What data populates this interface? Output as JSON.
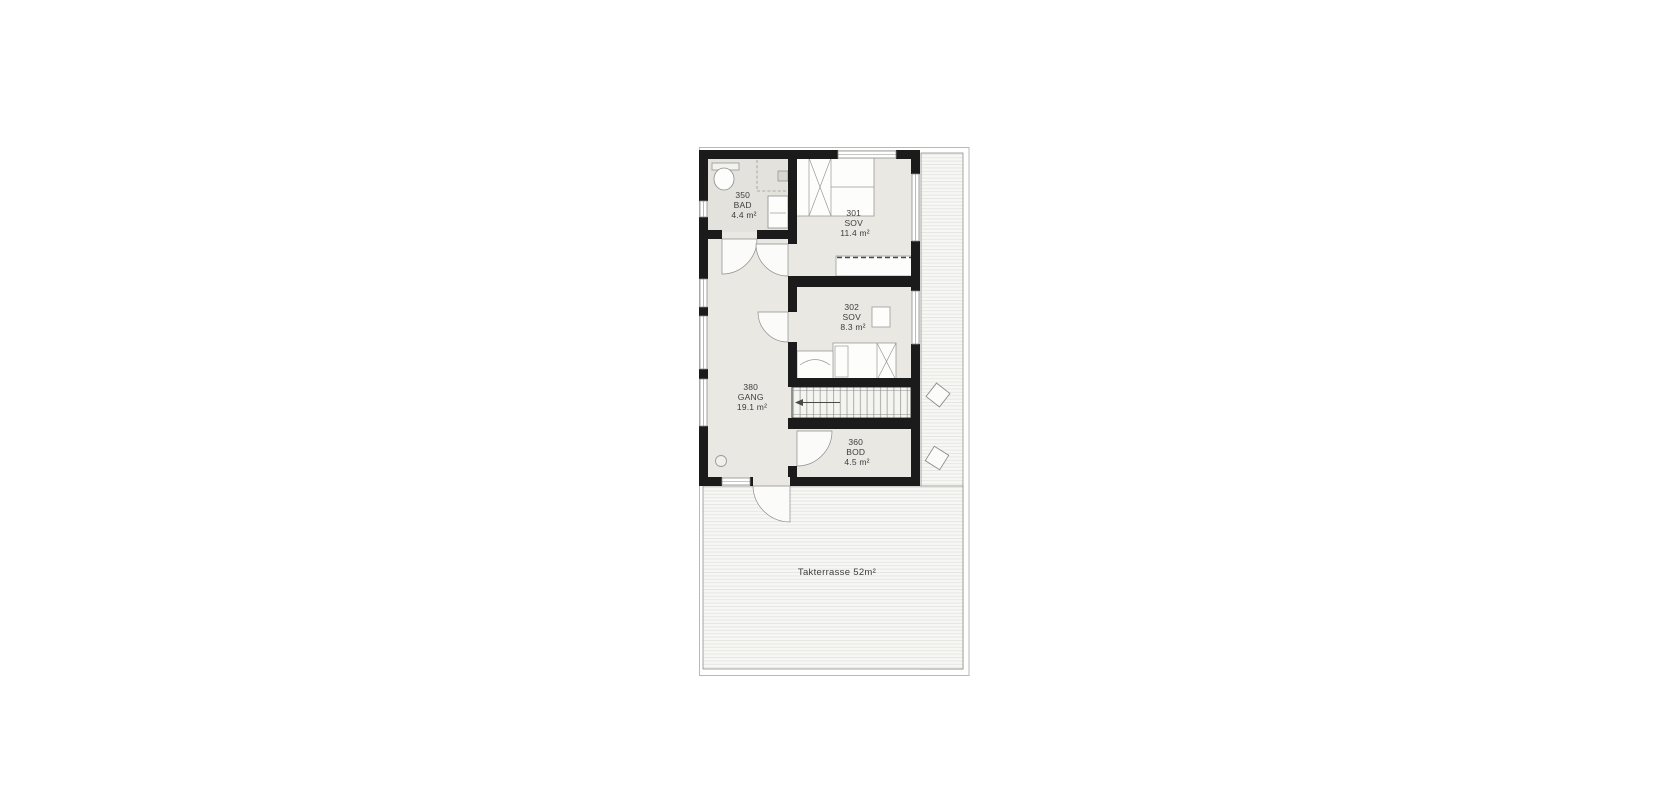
{
  "floorplan": {
    "title": "Upper floor plan with roof terrace",
    "rooms": [
      {
        "number": "350",
        "type": "BAD",
        "area": "4.4 m²"
      },
      {
        "number": "301",
        "type": "SOV",
        "area": "11.4 m²"
      },
      {
        "number": "302",
        "type": "SOV",
        "area": "8.3 m²"
      },
      {
        "number": "380",
        "type": "GANG",
        "area": "19.1 m²"
      },
      {
        "number": "360",
        "type": "BOD",
        "area": "4.5 m²"
      }
    ],
    "terrace": {
      "label": "Takterrasse 52m²"
    },
    "colors": {
      "wall": "#1b1b1b",
      "room_floor": "#e9e8e3",
      "bath_floor": "#e3e2dd",
      "deck_background": "#f7f7f5",
      "deck_stripe": "#e6e6e2",
      "outline": "#8c8c8c",
      "label_text": "#3d3d3d"
    }
  }
}
